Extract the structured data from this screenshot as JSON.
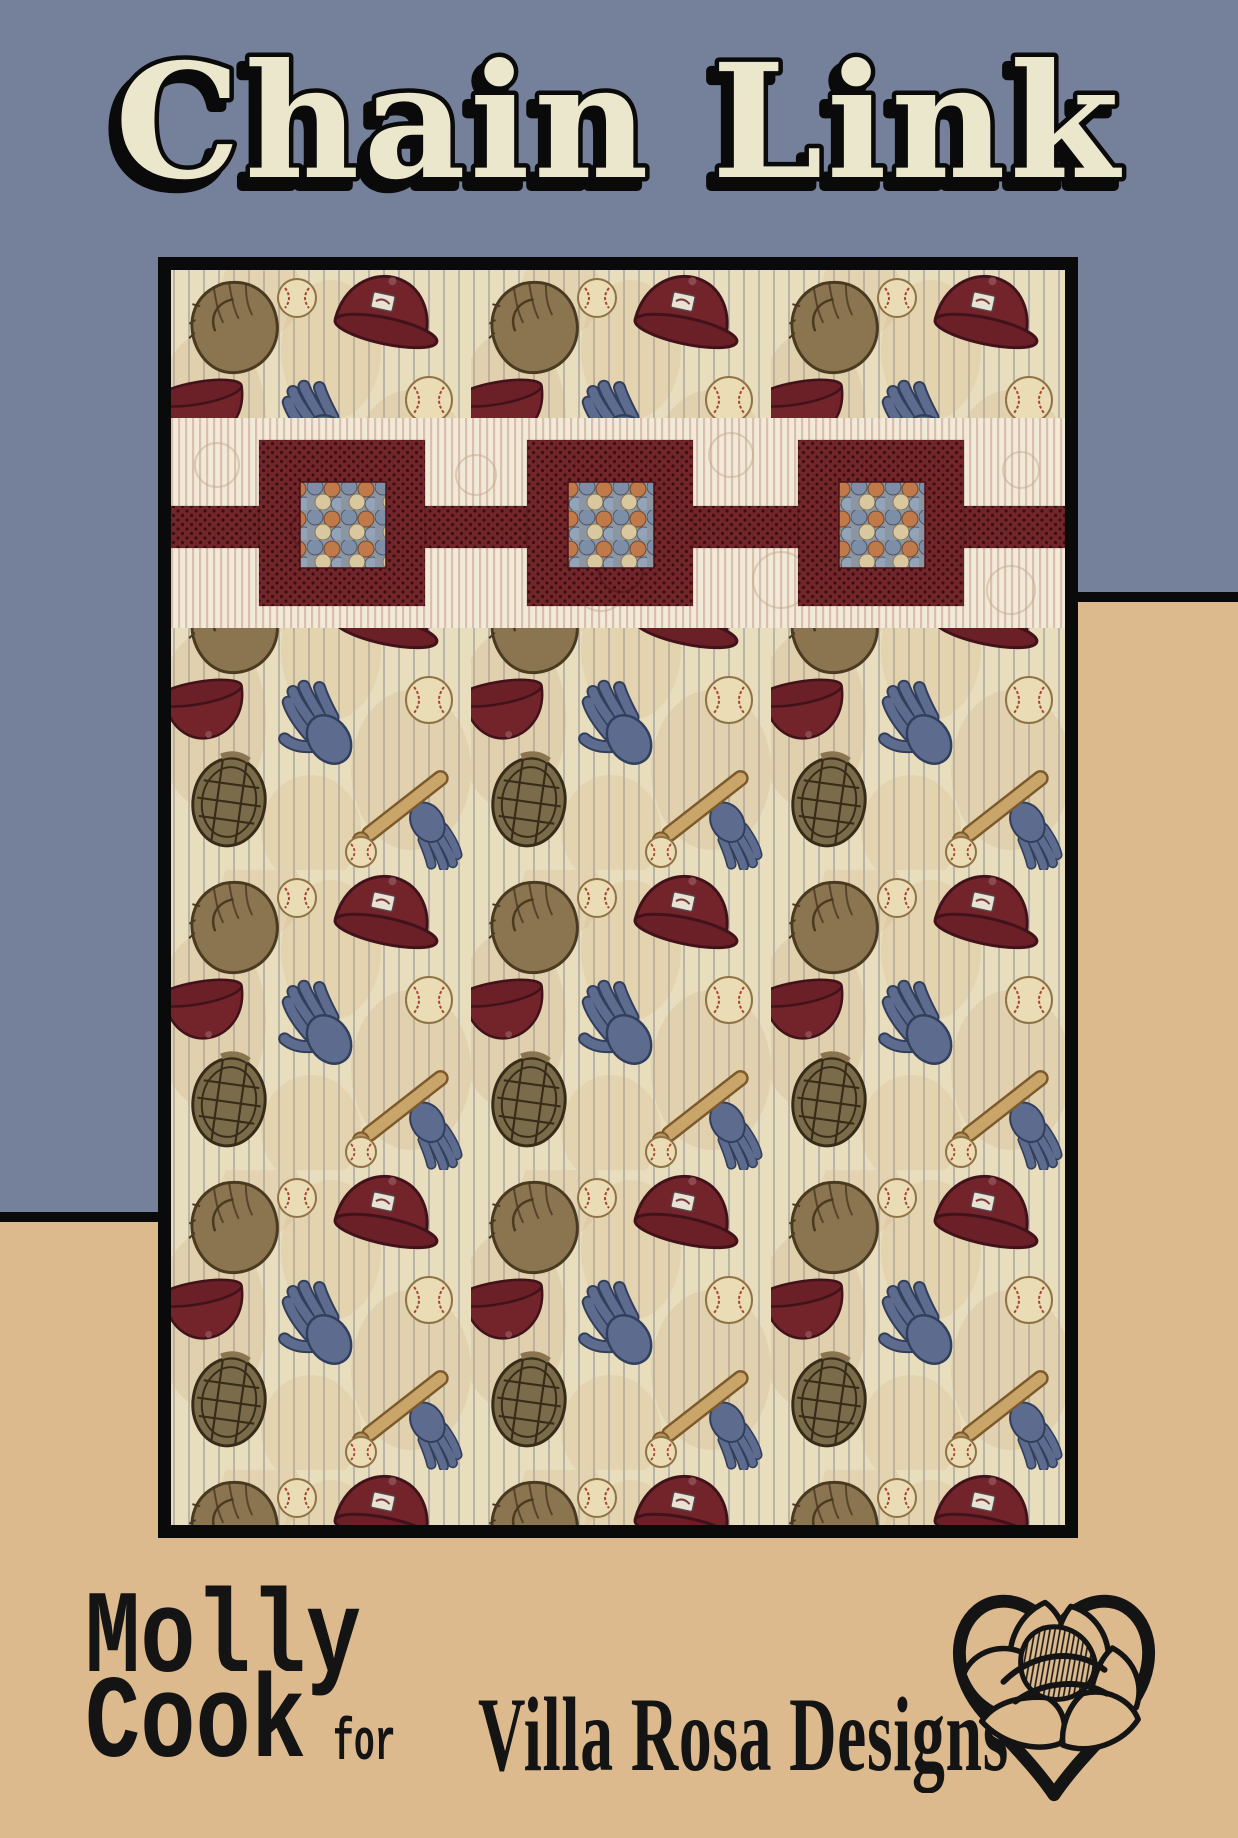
{
  "title": "Chain Link",
  "author": {
    "first_name": "Molly",
    "last_name": "Cook",
    "connector": "for"
  },
  "brand": {
    "name": "Villa Rosa Designs",
    "logo": "rose-in-heart"
  },
  "quilt_photo": {
    "description": "Quilt with baseball novelty print: pinstriped cream ground scattered with brown leather gloves, catcher masks, maroon caps, blue batting gloves, baseballs and bats. A cream pinstripe band crosses the upper third with three maroon polka-dot chain squares joined by maroon bars; each square holds a mini baseball-print center.",
    "motifs": [
      "baseball glove",
      "catcher mask",
      "maroon cap",
      "blue batting glove",
      "baseball",
      "bat"
    ]
  },
  "colors": {
    "blue_bg": "#75809a",
    "tan_bg": "#dcba8e",
    "frame_black": "#0a0a0a",
    "title_cream": "#ebe7cc",
    "chain_maroon": "#72262a",
    "chain_dot": "#3a0f13",
    "band_cream": "#f2ead9",
    "band_stripe": "#d9bfae",
    "fabric_cream": "#e8ddbd",
    "text_black": "#141414"
  }
}
